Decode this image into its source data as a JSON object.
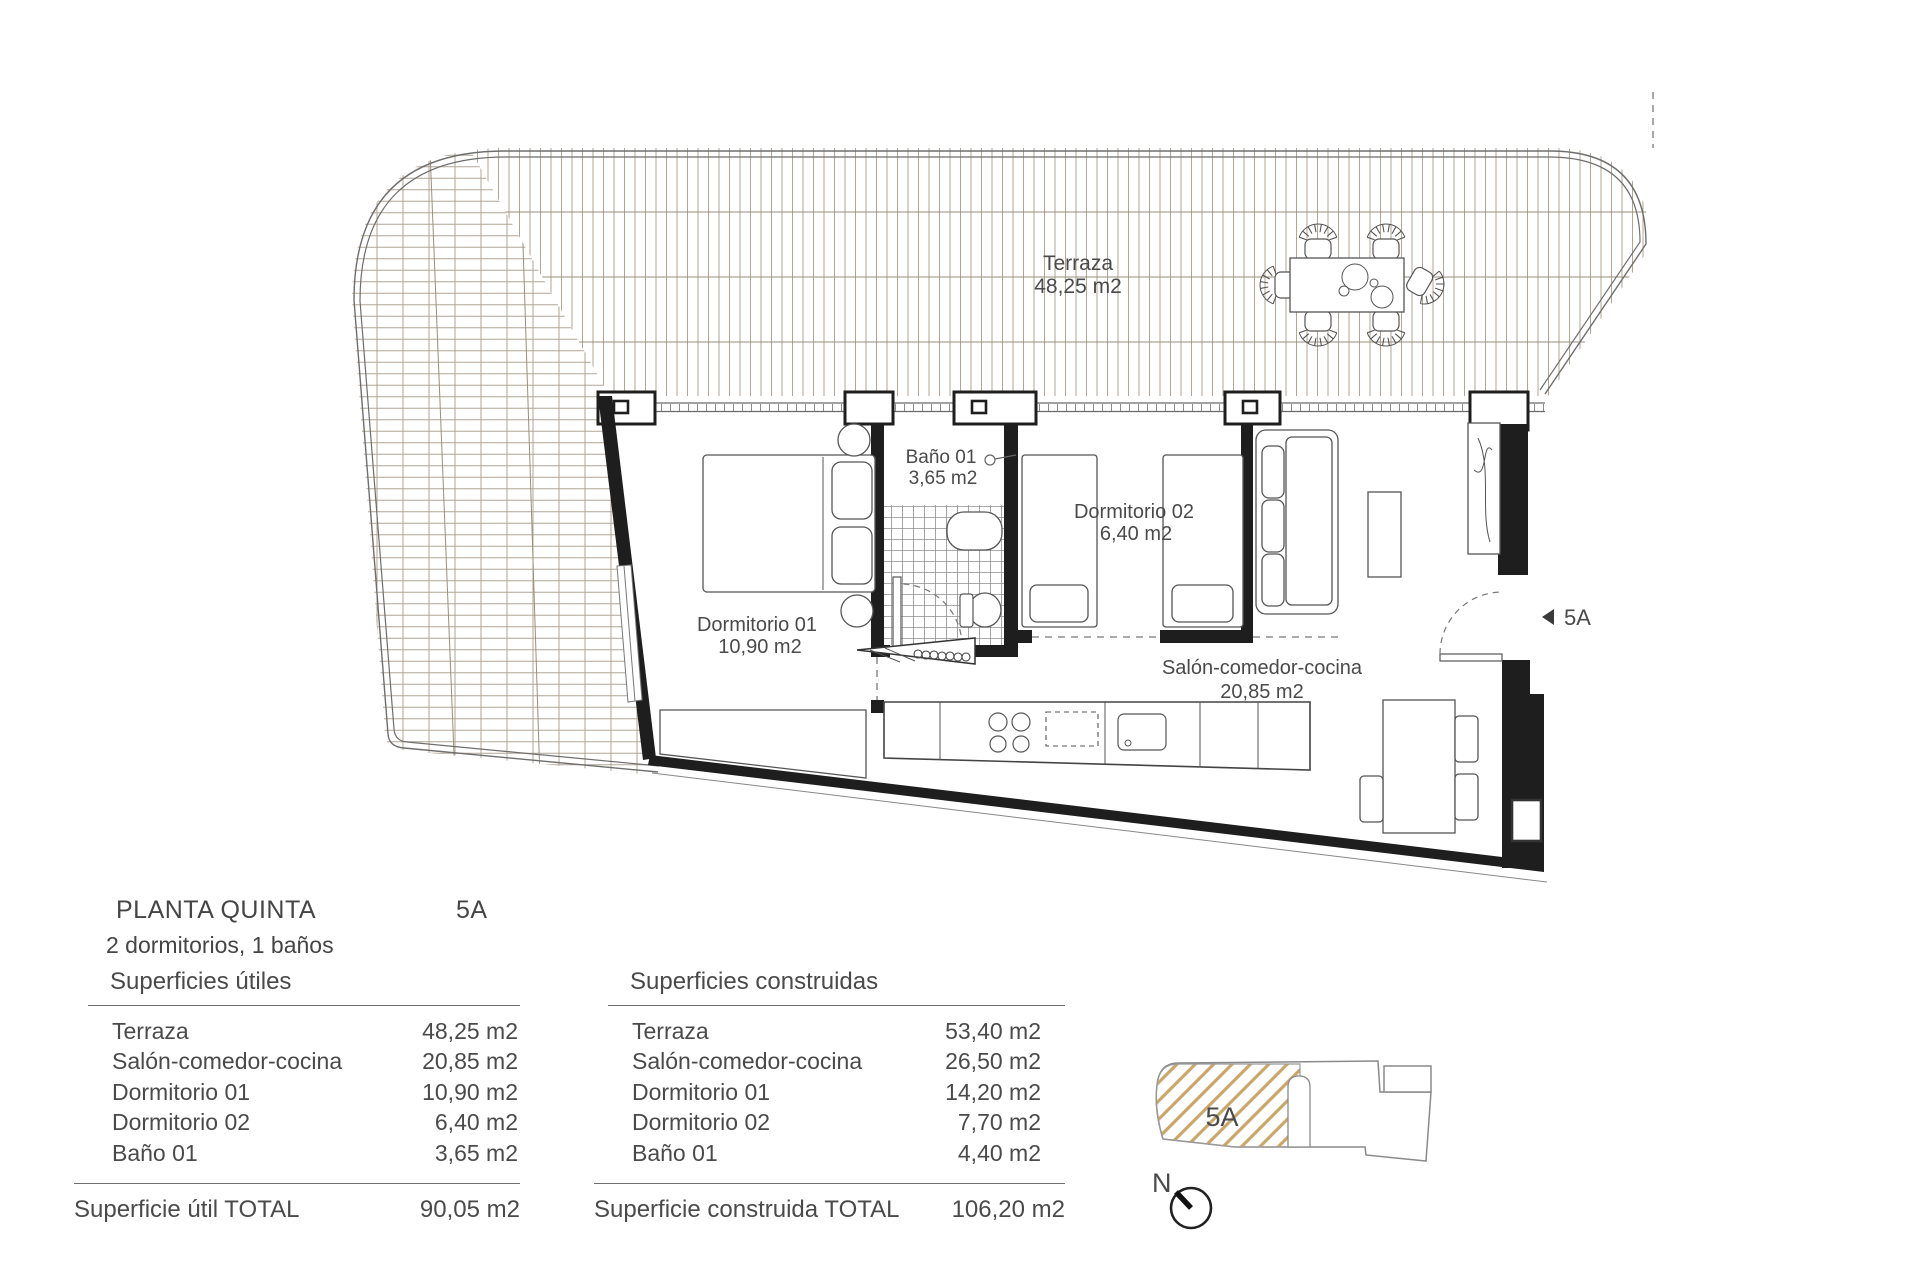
{
  "plan": {
    "terrace": {
      "name": "Terraza",
      "area": "48,25 m2"
    },
    "bath": {
      "name": "Baño 01",
      "area": "3,65 m2"
    },
    "bedroom2": {
      "name": "Dormitorio 02",
      "area": "6,40 m2"
    },
    "bedroom1": {
      "name": "Dormitorio 01",
      "area": "10,90 m2"
    },
    "living": {
      "name": "Salón-comedor-cocina",
      "area": "20,85 m2"
    },
    "unit_marker": "5A"
  },
  "info": {
    "floor_title": "PLANTA QUINTA",
    "unit": "5A",
    "program": "2 dormitorios, 1 baños"
  },
  "tables": {
    "useful": {
      "title": "Superficies útiles",
      "rows": [
        {
          "name": "Terraza",
          "value": "48,25 m2"
        },
        {
          "name": "Salón-comedor-cocina",
          "value": "20,85 m2"
        },
        {
          "name": "Dormitorio 01",
          "value": "10,90 m2"
        },
        {
          "name": "Dormitorio 02",
          "value": "6,40 m2"
        },
        {
          "name": "Baño 01",
          "value": "3,65 m2"
        }
      ],
      "total_label": "Superficie útil TOTAL",
      "total_value": "90,05 m2"
    },
    "built": {
      "title": "Superficies construidas",
      "rows": [
        {
          "name": "Terraza",
          "value": "53,40 m2"
        },
        {
          "name": "Salón-comedor-cocina",
          "value": "26,50 m2"
        },
        {
          "name": "Dormitorio 01",
          "value": "14,20 m2"
        },
        {
          "name": "Dormitorio 02",
          "value": "7,70 m2"
        },
        {
          "name": "Baño 01",
          "value": "4,40 m2"
        }
      ],
      "total_label": "Superficie construida TOTAL",
      "total_value": "106,20 m2"
    }
  },
  "keyplan": {
    "unit": "5A",
    "north": "N"
  },
  "colors": {
    "deck_line": "#b0a697",
    "deck_divider": "#998f7d",
    "wall": "#1e1e1e",
    "thin_line": "#5a5a5a",
    "boundary": "#6e6e6e",
    "hatch": "#c9a769",
    "text": "#4a4a4a"
  }
}
